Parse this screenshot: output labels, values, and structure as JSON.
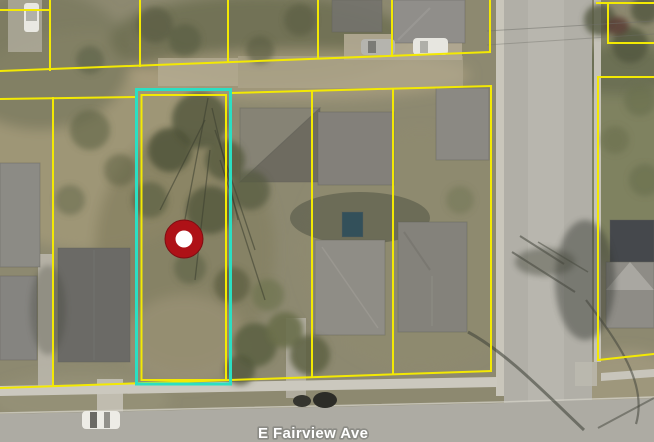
{
  "map": {
    "type": "aerial-parcel-map",
    "street_label": "E Fairview Ave",
    "marker_icon": "location-marker-icon",
    "selected_parcel_highlighted": true,
    "colors": {
      "parcel-line": "#f3e903",
      "selected-parcel-outline": "#2bdfc3",
      "marker-fill": "#ae1117",
      "marker-center": "#ffffff",
      "street-label-fill": "#ffffff",
      "street-label-outline": "#8b8b85"
    }
  }
}
